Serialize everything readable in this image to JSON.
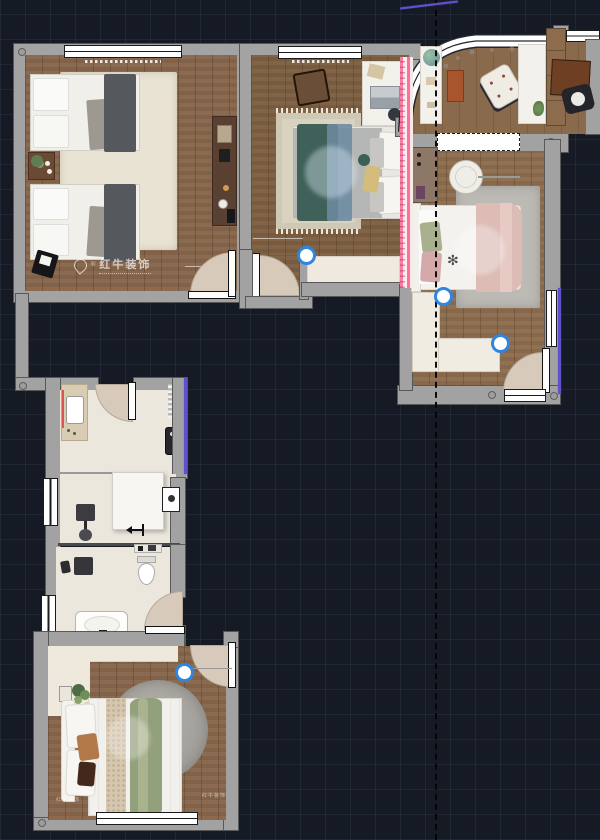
{
  "scene": {
    "type": "interior floor plan, rendered top view on dark CAD canvas",
    "canvas_bg": "#151a24",
    "grid": "25px square grid, faint",
    "section_line": "vertical dashed black line near x=436"
  },
  "watermark": {
    "brand": "红牛装饰",
    "reg": "®",
    "corner_mark": "红牛装饰"
  },
  "icons": {
    "flower": "✻"
  },
  "palette": {
    "wall": "#a2a2a2",
    "wood_floor": "#86654a",
    "cream_floor": "#ebe7dd",
    "accent_pink": "#ff6f9e",
    "accent_purple": "#5e51cc",
    "accent_red": "#e0524e",
    "marker_blue": "#2f86e0",
    "door_fan": "#d7cabb",
    "teal_blanket": "#3f6159",
    "blue_blanket": "#6c8ba0",
    "sage_blanket": "#93a07c",
    "pink_blanket": "#dcbcb4"
  },
  "markers": [
    {
      "id": "door-n-bedroom",
      "x": 303,
      "y": 252
    },
    {
      "id": "corridor-corner-1",
      "x": 440,
      "y": 293
    },
    {
      "id": "corridor-corner-2",
      "x": 497,
      "y": 340
    },
    {
      "id": "door-s-bedroom",
      "x": 181,
      "y": 669
    }
  ],
  "rooms": [
    {
      "id": "bedroom-nw",
      "furniture": [
        "single-bed x2",
        "bedside-table",
        "plant",
        "tv-cabinet",
        "black-chair",
        "cream-rug",
        "top-window",
        "door"
      ]
    },
    {
      "id": "bedroom-n",
      "furniture": [
        "double-bed teal/blue",
        "desk",
        "laptop",
        "wood-chair",
        "stools",
        "fringed-rug",
        "pink-wardrobe-strip",
        "top-window",
        "door",
        "bay-floor"
      ]
    },
    {
      "id": "study-ne",
      "furniture": [
        "curved-bay-window",
        "side-desk",
        "globe",
        "brown-rug",
        "armchair",
        "long-desk",
        "shelf-band",
        "brown-table",
        "black-chair",
        "dashed-opening"
      ]
    },
    {
      "id": "bedroom-e",
      "furniture": [
        "double-bed pink",
        "round-chair",
        "floor-lamp",
        "dresser",
        "gray-rug",
        "entry-door",
        "right-window",
        "bottom-window",
        "corridor-L"
      ]
    },
    {
      "id": "kitchen",
      "furniture": [
        "counter-with-sink",
        "water-heater",
        "shutter",
        "door"
      ]
    },
    {
      "id": "utility-room",
      "furniture": [
        "shower-box",
        "desk-chair",
        "door-direction-arrow",
        "wall-appliance"
      ]
    },
    {
      "id": "bathroom",
      "furniture": [
        "toilet",
        "bathtub",
        "vanity-table",
        "stool",
        "shelf",
        "door",
        "side-windows"
      ]
    },
    {
      "id": "bedroom-s",
      "furniture": [
        "double-bed sage",
        "round-rug",
        "plant",
        "picture-frame",
        "wardrobe-strip",
        "door",
        "bottom-window"
      ]
    }
  ]
}
